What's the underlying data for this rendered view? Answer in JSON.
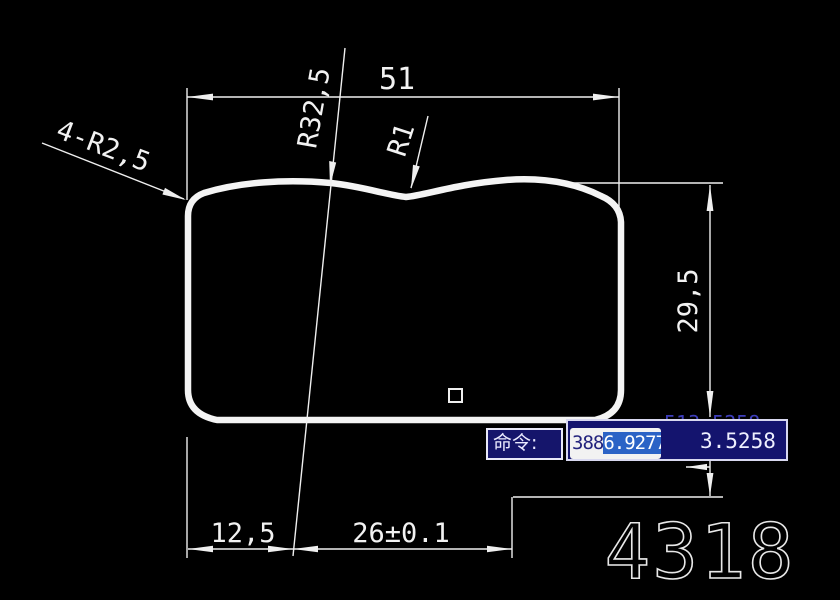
{
  "app": {
    "type": "cad-viewport",
    "colors": {
      "background": "#000000",
      "line": "#efefef",
      "panel_navy": "#14146e",
      "selection_blue": "#2b63c6",
      "clipped_text_blue": "#3d3dbb",
      "prompt_text": "#eaeaff"
    }
  },
  "drawing": {
    "part_number": "4318",
    "dimensions": {
      "top_width": "51",
      "top_radius": "R32,5",
      "notch_radius": "R1",
      "corner_radii": "4-R2,5",
      "right_height": "29,5",
      "bottom_left_offset": "12,5",
      "bottom_width_tolerance": "26±0.1"
    }
  },
  "command_bar": {
    "prompt": "命令:"
  },
  "dynamic_input": {
    "x_value_prefix": "388",
    "x_value_selected": "6.9277",
    "y_value_visible": "3.5258",
    "clipped_value": "513.5258"
  }
}
